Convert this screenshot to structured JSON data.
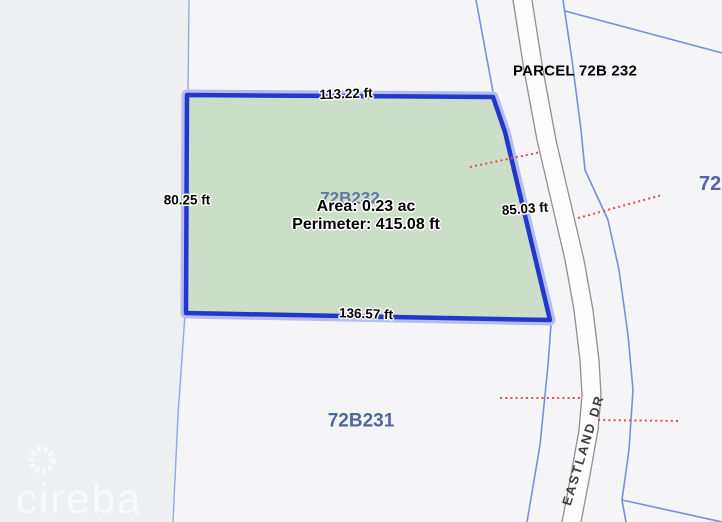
{
  "map": {
    "labels": {
      "parcel_title": "PARCEL 72B 232",
      "selected_parcel_id": "72B232",
      "south_parcel_id": "72B231",
      "east_parcel_id_partial": "72",
      "road_name": "EASTLAND DR"
    },
    "measurements": {
      "top_edge": "113.22 ft",
      "left_edge": "80.25 ft",
      "right_edge": "85.03 ft",
      "bottom_edge": "136.57 ft",
      "area": "Area: 0.23 ac",
      "perimeter": "Perimeter: 415.08 ft"
    },
    "colors": {
      "parcel_fill": "#cbdec7",
      "parcel_stroke": "#2336ce",
      "parcel_halo": "#b3bdee",
      "boundary_line": "#7490dc",
      "leader_dotted": "#dd5050",
      "parcel_id_text": "#51669f",
      "road_edge": "#8f8f8f"
    }
  },
  "watermark": {
    "brand": "cireba"
  }
}
